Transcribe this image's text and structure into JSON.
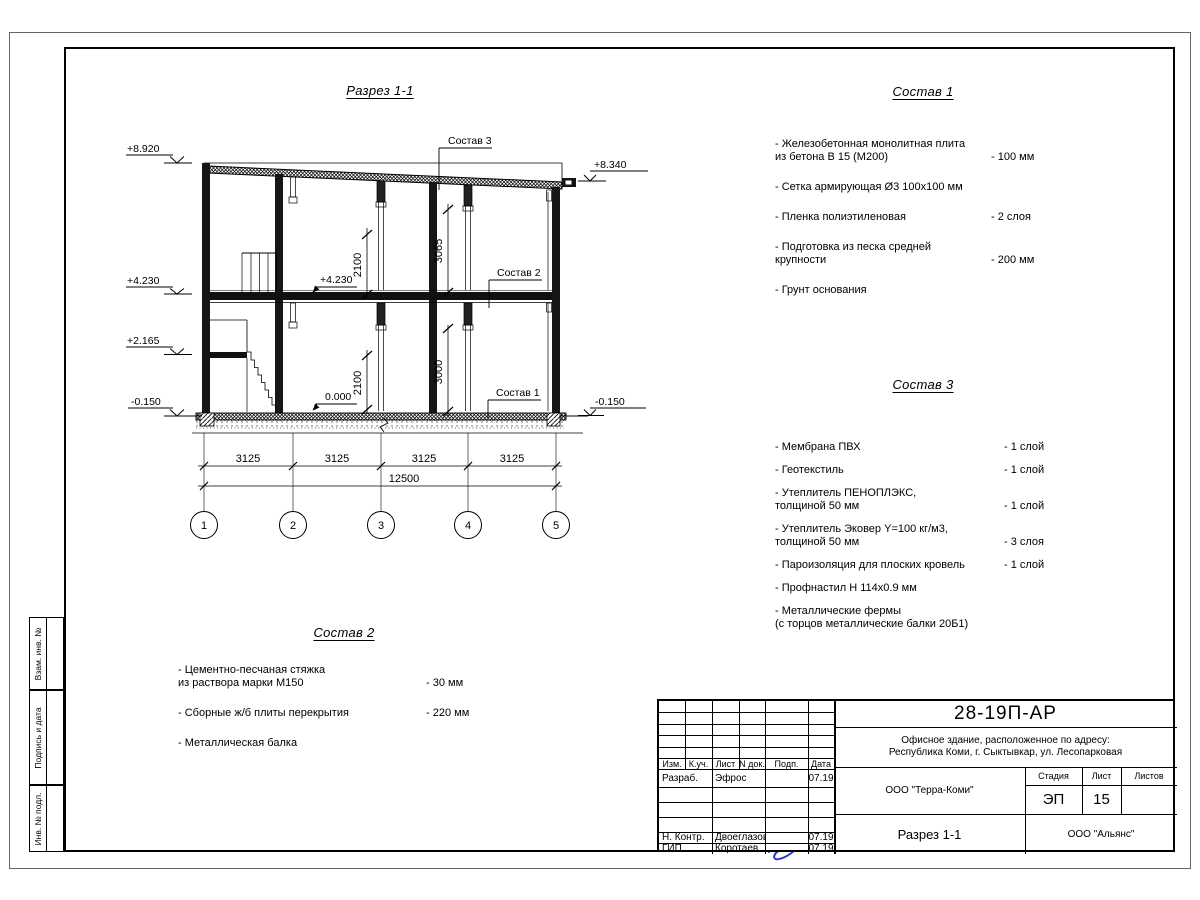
{
  "sheet": {
    "stamp_vertical_1": "Взам. инв. №",
    "stamp_vertical_2": "Подпись и дата",
    "stamp_vertical_3": "Инв. № подл."
  },
  "drawing": {
    "title": "Разрез 1-1",
    "callout_sostav3": "Состав 3",
    "callout_sostav2": "Состав 2",
    "callout_sostav1": "Состав 1",
    "elev_left": [
      "+8.920",
      "+4.230",
      "+2.165",
      "-0.150"
    ],
    "elev_right_top": "+8.340",
    "elev_right_bottom": "-0.150",
    "elev_inner_top": "+4.230",
    "elev_inner_bottom": "0.000",
    "dim_2100_top": "2100",
    "dim_3065": "3065",
    "dim_3000": "3000",
    "dim_2100_bottom": "2100",
    "span_dims": [
      "3125",
      "3125",
      "3125",
      "3125"
    ],
    "total_dim": "12500",
    "grid_bubbles": [
      "1",
      "2",
      "3",
      "4",
      "5"
    ]
  },
  "sostav1": {
    "title": "Состав 1",
    "items": [
      {
        "text": "- Железобетонная  монолитная плита\nиз бетона В 15 (М200)",
        "value": "- 100 мм"
      },
      {
        "text": "- Сетка армирующая Ø3 100х100 мм",
        "value": ""
      },
      {
        "text": "- Пленка полиэтиленовая",
        "value": "-  2 слоя"
      },
      {
        "text": "- Подготовка из песка средней\nкрупности",
        "value": "- 200 мм"
      },
      {
        "text": "- Грунт основания",
        "value": ""
      }
    ]
  },
  "sostav3": {
    "title": "Состав 3",
    "items": [
      {
        "text": "- Мембрана ПВХ",
        "value": "- 1 слой"
      },
      {
        "text": "- Геотекстиль",
        "value": "- 1 слой"
      },
      {
        "text": "- Утеплитель ПЕНОПЛЭКС,\nтолщиной 50 мм",
        "value": "- 1 слой"
      },
      {
        "text": "- Утеплитель Эковер Y=100 кг/м3,\nтолщиной 50 мм",
        "value": "- 3 слоя"
      },
      {
        "text": "- Пароизоляция для плоских кровель",
        "value": "- 1 слой"
      },
      {
        "text": "- Профнастил Н 114х0.9 мм",
        "value": ""
      },
      {
        "text": "- Металлические фермы\n(с торцов металлические балки 20Б1)",
        "value": ""
      }
    ]
  },
  "sostav2": {
    "title": "Состав 2",
    "items": [
      {
        "text": "- Цементно-песчаная стяжка\nиз раствора марки М150",
        "value": "- 30 мм"
      },
      {
        "text": "- Сборные ж/б плиты перекрытия",
        "value": "- 220 мм"
      },
      {
        "text": "- Металлическая балка",
        "value": ""
      }
    ]
  },
  "titleblock": {
    "doc_number": "28-19П-АР",
    "address_line1": "Офисное здание, расположенное по адресу:",
    "address_line2": "Республика Коми, г. Сыктывкар, ул. Лесопарковая",
    "company": "ООО \"Терра-Коми\"",
    "stage_label": "Стадия",
    "sheet_label": "Лист",
    "sheets_label": "Листов",
    "stage": "ЭП",
    "sheet_num": "15",
    "drawing_name": "Разрез 1-1",
    "contractor": "ООО \"Альянс\"",
    "header_cols": [
      "Изм.",
      "К.уч.",
      "Лист",
      "N док.",
      "Подп.",
      "Дата"
    ],
    "rows": [
      {
        "role": "Разраб.",
        "name": "Эфрос",
        "date": "07.19"
      },
      {
        "role": "Н. Контр.",
        "name": "Двоеглазов",
        "date": "07.19"
      },
      {
        "role": "ГИП",
        "name": "Коротаев",
        "date": "07.19"
      }
    ],
    "accent_signature_color": "#2436c8"
  }
}
